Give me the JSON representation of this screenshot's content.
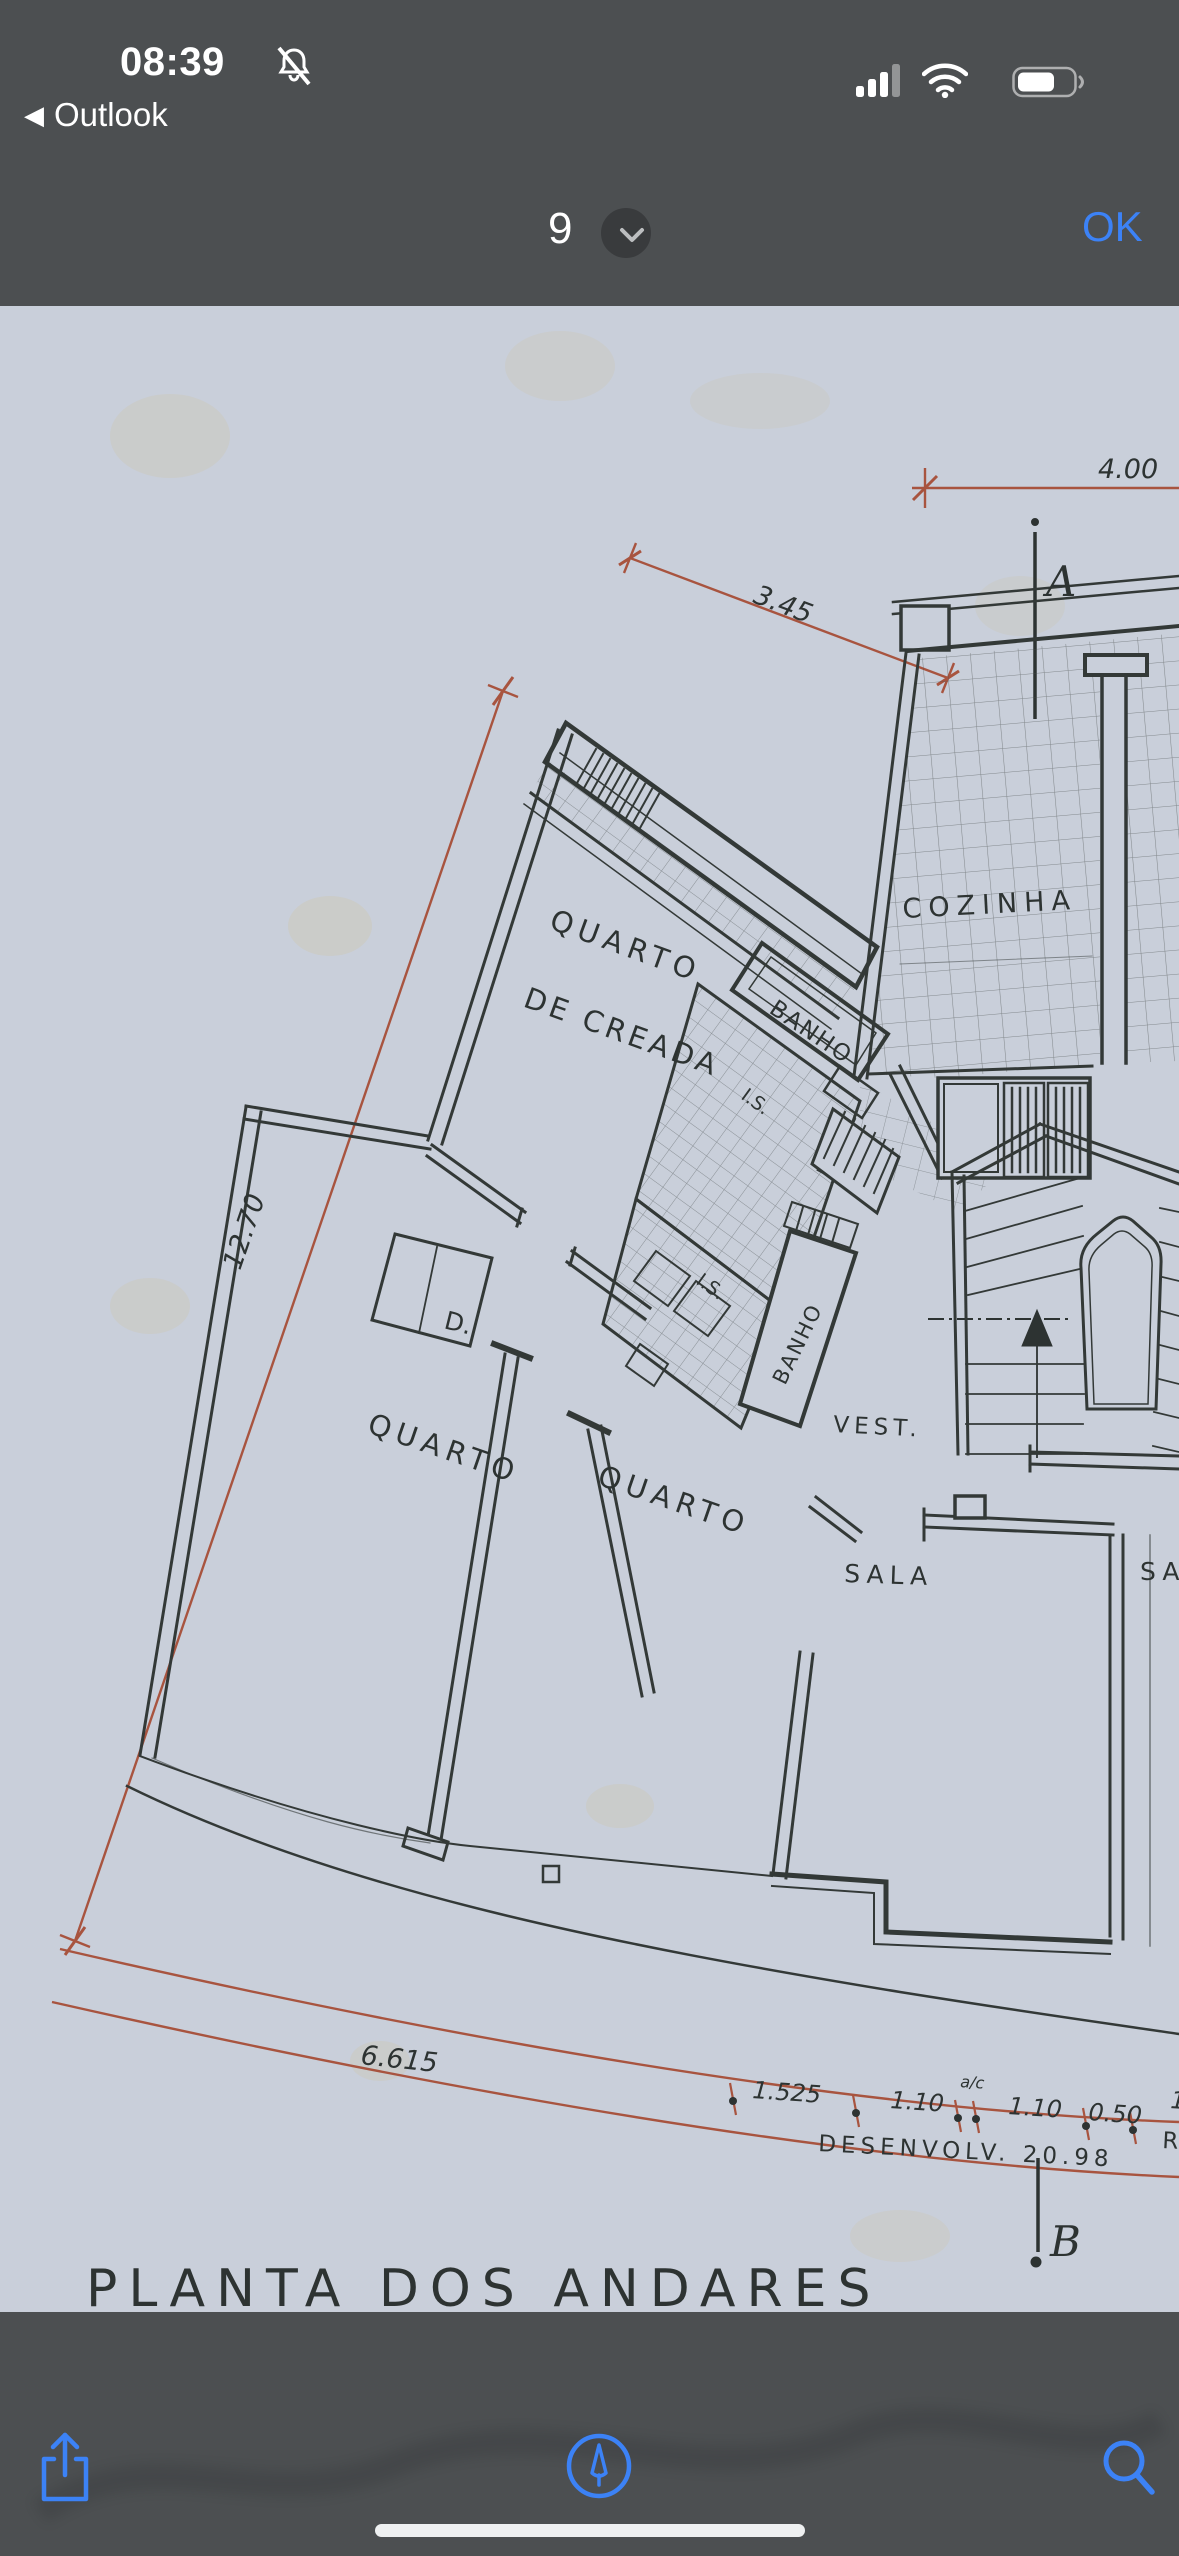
{
  "status_bar": {
    "time": "08:39",
    "back_chevron": "◀",
    "back_label": "Outlook",
    "silenced_icon": "bell-slash-icon",
    "signal_icon": "cellular-signal-3-of-4",
    "wifi_icon": "wifi-full",
    "battery_icon": "battery-60-percent"
  },
  "nav_bar": {
    "page_number": "9",
    "ok_label": "OK"
  },
  "plan": {
    "title": "PLANTA  DOS  ANDARES",
    "rooms": {
      "maid_room_line1": "QUARTO",
      "maid_room_line2": "DE CREADA",
      "bath_top": "BANHO",
      "wc_upper": "I.S.",
      "wc_lower": "I.S.",
      "bath_vertical": "BANHO",
      "kitchen": "COZINHA",
      "vestibule": "VEST.",
      "closet": "D.",
      "bedroom_left": "QUARTO",
      "bedroom_mid": "QUARTO",
      "living": "SALA",
      "living_partial": "SA"
    },
    "dimensions": {
      "top_width": "4.00",
      "diagonal": "3.45",
      "left_length": "12.70",
      "bottom_left": "6.615",
      "seg_1": "1.525",
      "seg_2": "1.10",
      "seg_note": "a/c",
      "seg_3": "1.10",
      "seg_4": "0.50",
      "seg_edge_fragment": "1",
      "development": "DESENVOLV. 20.98",
      "development_fragment": "R"
    },
    "markers": {
      "section_top": "A",
      "section_bottom": "B"
    }
  },
  "toolbar": {
    "share_icon": "share",
    "markup_icon": "markup-pen",
    "search_icon": "magnifier"
  },
  "colors": {
    "chrome": "#4c4f51",
    "paper": "#c9cfda",
    "ink": "#333937",
    "dimension_red": "#a8543f",
    "accent_blue": "#3c82f6"
  }
}
